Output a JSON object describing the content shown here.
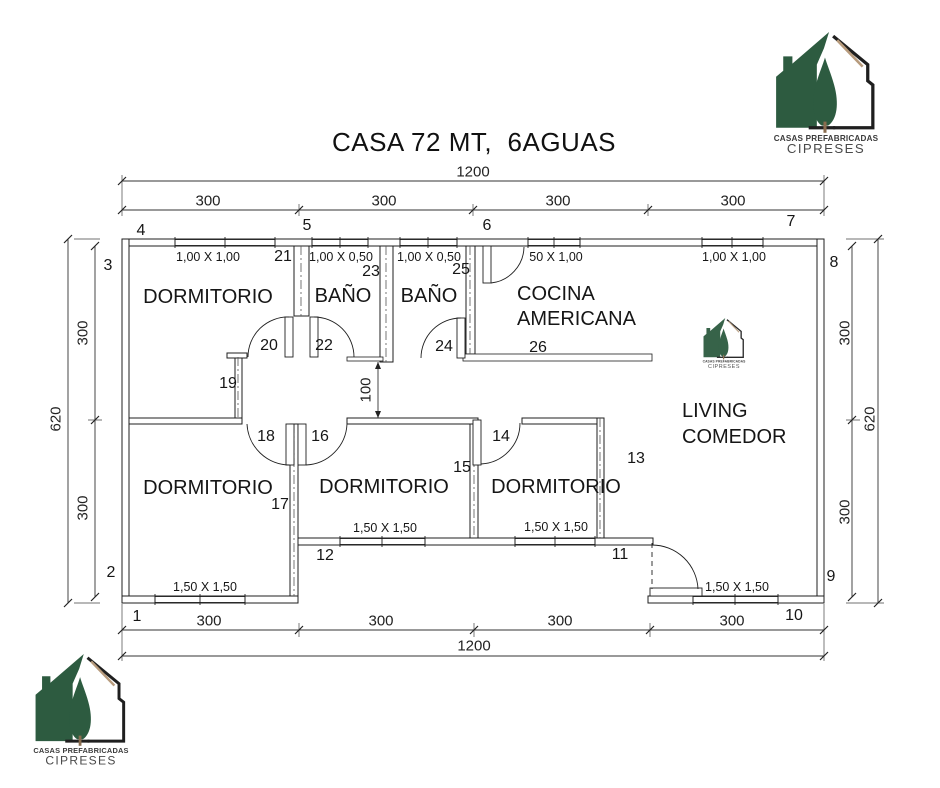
{
  "title": "CASA 72 MT,  6AGUAS",
  "logo": {
    "line1": "CASAS PREFABRICADAS",
    "line2": "CIPRESES"
  },
  "colors": {
    "logo_green": "#2d5b40",
    "logo_beam": "#b79b7d",
    "line": "#1f1f1f"
  },
  "rooms": {
    "dorm_nw": "DORMITORIO",
    "bano1": "BAÑO",
    "bano2": "BAÑO",
    "cocina1": "COCINA",
    "cocina2": "AMERICANA",
    "living1": "LIVING",
    "living2": "COMEDOR",
    "dorm_sw": "DORMITORIO",
    "dorm_s": "DORMITORIO",
    "dorm_se": "DORMITORIO"
  },
  "windows": {
    "nw": "1,00 X 1,00",
    "bano1": "1,00 X 0,50",
    "bano2": "1,00 X 0,50",
    "cocina": "50 X 1,00",
    "ne": "1,00 X 1,00",
    "sw": "1,50 X 1,50",
    "s1": "1,50 X 1,50",
    "s2": "1,50 X 1,50",
    "entrance": "1,50 X 1,50"
  },
  "dimensions": {
    "top_total": "1200",
    "bottom_total": "1200",
    "left_total": "620",
    "right_total": "620",
    "top": [
      "300",
      "300",
      "300",
      "300"
    ],
    "bottom": [
      "300",
      "300",
      "300",
      "300"
    ],
    "left": [
      "300",
      "300"
    ],
    "right": [
      "300",
      "300"
    ],
    "hall": "100"
  },
  "points": {
    "n1": "1",
    "n2": "2",
    "n3": "3",
    "n4": "4",
    "n5": "5",
    "n6": "6",
    "n7": "7",
    "n8": "8",
    "n9": "9",
    "n10": "10",
    "n11": "11",
    "n12": "12",
    "n13": "13",
    "n14": "14",
    "n15": "15",
    "n16": "16",
    "n17": "17",
    "n18": "18",
    "n19": "19",
    "n20": "20",
    "n21": "21",
    "n22": "22",
    "n23": "23",
    "n24": "24",
    "n25": "25",
    "n26": "26"
  }
}
